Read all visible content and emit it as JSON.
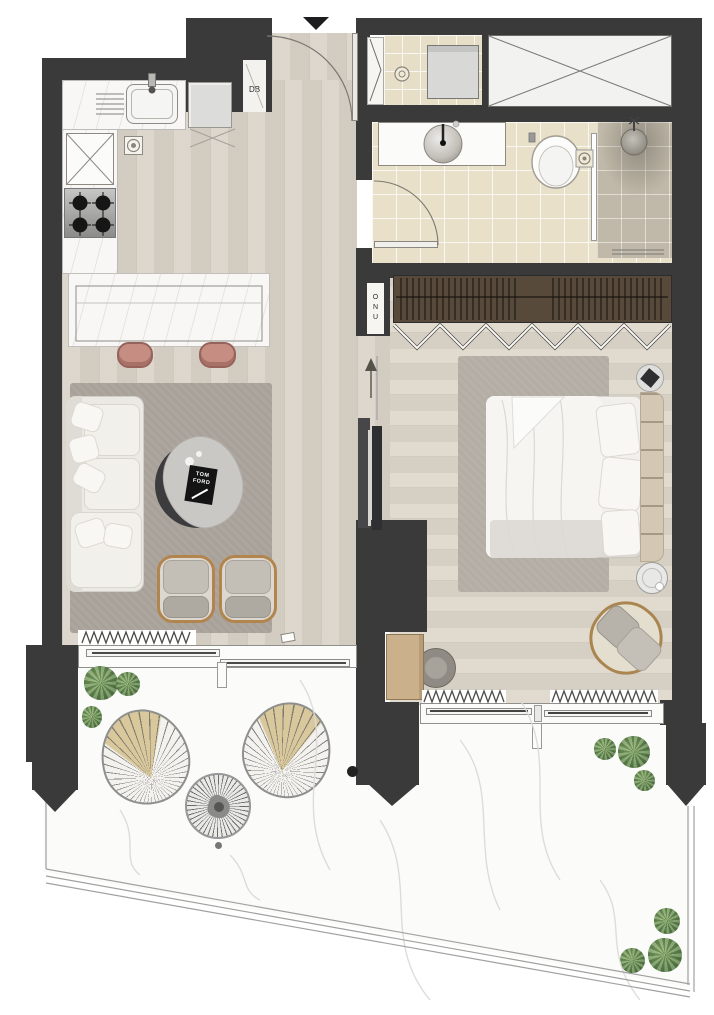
{
  "labels": {
    "db": "DB",
    "shaft": "ONU",
    "book_line1": "TOM",
    "book_line2": "FORD"
  },
  "palette": {
    "wall": "#3a3a3b",
    "wood_floor_living": "#d9d2c7",
    "wood_floor_bedroom": "#ddd6ca",
    "bathroom_tile": "#e8e0c8",
    "shower_tile": "#c0b9a9",
    "counter_marble": "#f8f7f5",
    "balcony_marble": "#fbfbfa",
    "rug_living": "#a8a199",
    "rug_bedroom": "#b3ada4",
    "wardrobe_wood": "#574a3b",
    "stool_accent": "#c68e83",
    "armchair_frame": "#b2854e",
    "lounge_cushion_tan": "#d9c89b",
    "plant_green": "#587f46",
    "headboard_tan": "#d4c8b4"
  }
}
